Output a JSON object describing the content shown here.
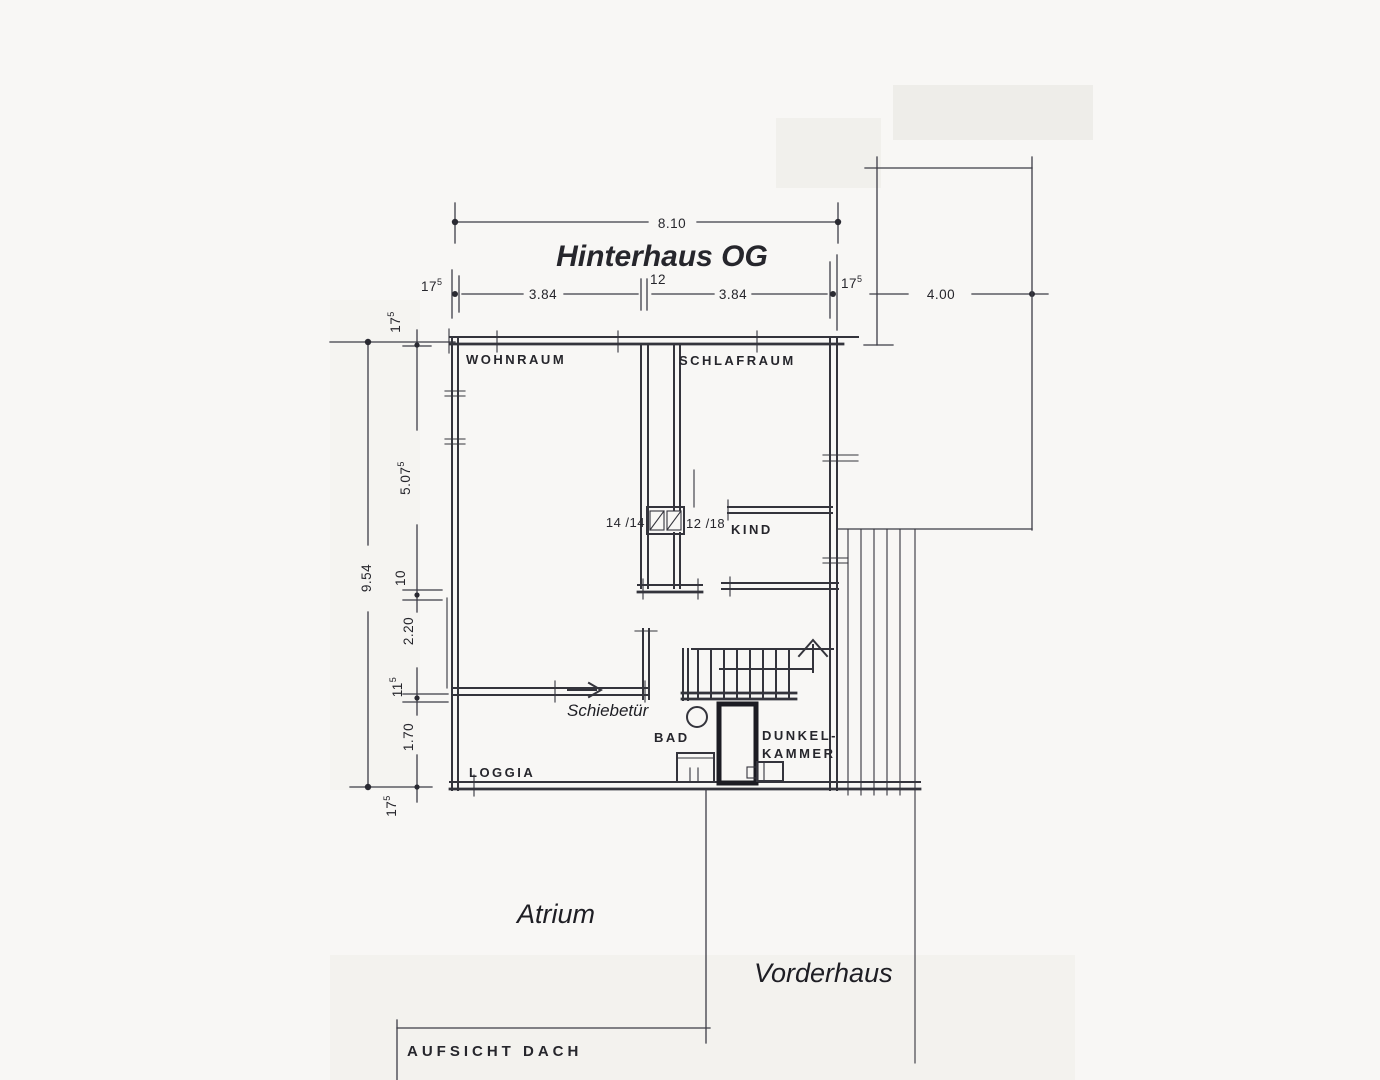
{
  "title": "Hinterhaus OG",
  "colors": {
    "title_red": "#9a1d1a",
    "ink": "#34343c",
    "paper": "#f6f5f2"
  },
  "rooms": {
    "wohnraum": "WOHNRAUM",
    "schlafraum": "SCHLAFRAUM",
    "kind": "KIND",
    "bad": "BAD",
    "dunkelkammer_line1": "DUNKEL-",
    "dunkelkammer_line2": "KAMMER",
    "loggia": "LOGGIA"
  },
  "annotations": {
    "schiebetuer": "Schiebetür",
    "atrium": "Atrium",
    "vorderhaus": "Vorderhaus",
    "aufsicht_dach": "AUFSICHT  DACH",
    "chimney_left": "14 /14",
    "chimney_right": "12 /18"
  },
  "dimensions": {
    "top_total": "8.10",
    "row": {
      "wall_left": "17",
      "wall_left_sup": "5",
      "seg_left": "3.84",
      "wall_mid_sup": "12",
      "seg_right": "3.84",
      "wall_right": "17",
      "wall_right_sup": "5",
      "annex_width": "4.00"
    },
    "left": {
      "wall_top": "17",
      "wall_top_sup": "5",
      "seg_upper": "5.07",
      "seg_upper_sup": "5",
      "total": "9.54",
      "wall_mid": "10",
      "seg_mid": "2.20",
      "wall_lower": "11",
      "wall_lower_sup": "5",
      "seg_lower": "1.70",
      "wall_bottom": "17",
      "wall_bottom_sup": "5"
    }
  }
}
